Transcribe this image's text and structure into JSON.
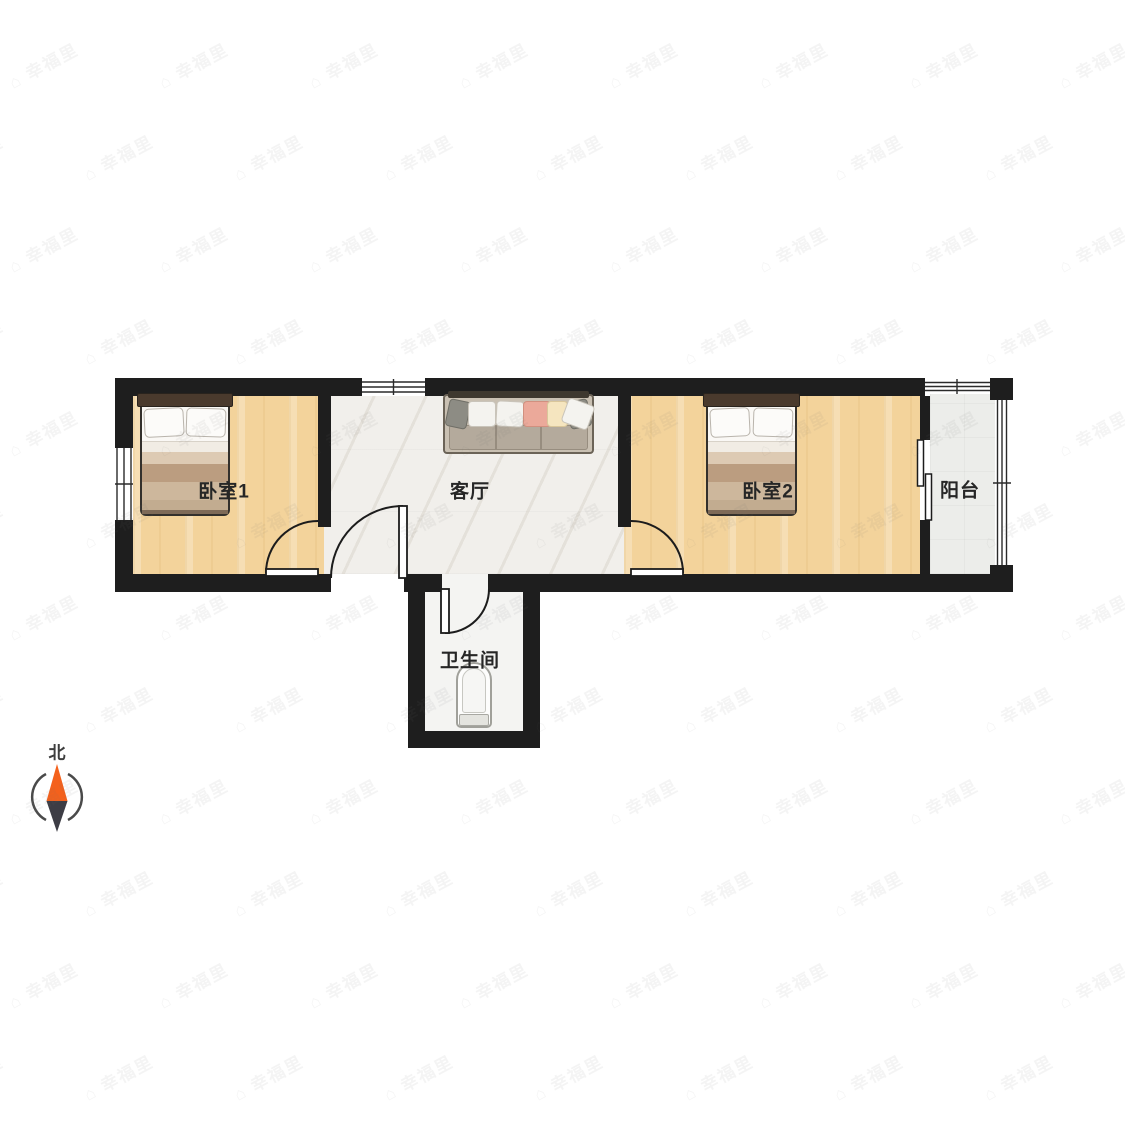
{
  "page": {
    "type": "apartment floor plan"
  },
  "rooms": {
    "bedroom1": {
      "label": "卧室1",
      "floor": "wood"
    },
    "living_room": {
      "label": "客厅",
      "floor": "marble"
    },
    "bedroom2": {
      "label": "卧室2",
      "floor": "wood"
    },
    "balcony": {
      "label": "阳台",
      "floor": "gray-tile"
    },
    "bathroom": {
      "label": "卫生间",
      "floor": "white-tile"
    }
  },
  "furniture": {
    "bedroom1_bed": "double-bed",
    "bedroom2_bed": "double-bed",
    "living_sofa": "sofa",
    "bathroom_toilet": "toilet"
  },
  "compass": {
    "label": "北",
    "north_needle_color": "#f4611c",
    "south_needle_color": "#3d3d45",
    "ring_color": "#4a4a4a"
  },
  "watermark": {
    "text": "幸福里",
    "icon": "house-icon"
  },
  "colors": {
    "wall": "#1e1e1e",
    "wood_floor": "#f3d39b",
    "marble_floor": "#f1efeb",
    "balcony_floor": "#ecedea",
    "bathroom_floor": "#f4f4f2",
    "label_text": "#262626"
  }
}
